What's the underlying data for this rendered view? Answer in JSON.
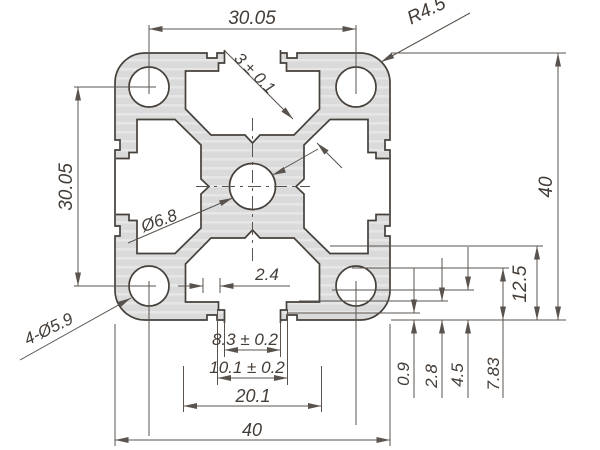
{
  "drawing": {
    "type": "extrusion-profile-cross-section",
    "colors": {
      "profile_fill": "#dadada",
      "profile_highlight": "#e6e6e6",
      "outline": "#46403b",
      "dimension_line": "#5a534d",
      "text": "#433c37",
      "background": "#ffffff"
    },
    "dimensions": {
      "top_hole_spacing": "30.05",
      "left_hole_spacing": "30.05",
      "corner_radius": "R4.5",
      "web_thickness": "3 ± 0.1",
      "overall_height": "40",
      "overall_width": "40",
      "center_hole": "Ø6.8",
      "corner_holes": "4-Ø5.9",
      "slot_depth": "12.5",
      "lip_length": "2.4",
      "slot_opening": "8.3 ± 0.2",
      "slot_throat": "10.1 ± 0.2",
      "cavity_width": "20.1",
      "step_a": "0.9",
      "step_b": "2.8",
      "step_c": "4.5",
      "step_d": "7.83"
    }
  }
}
